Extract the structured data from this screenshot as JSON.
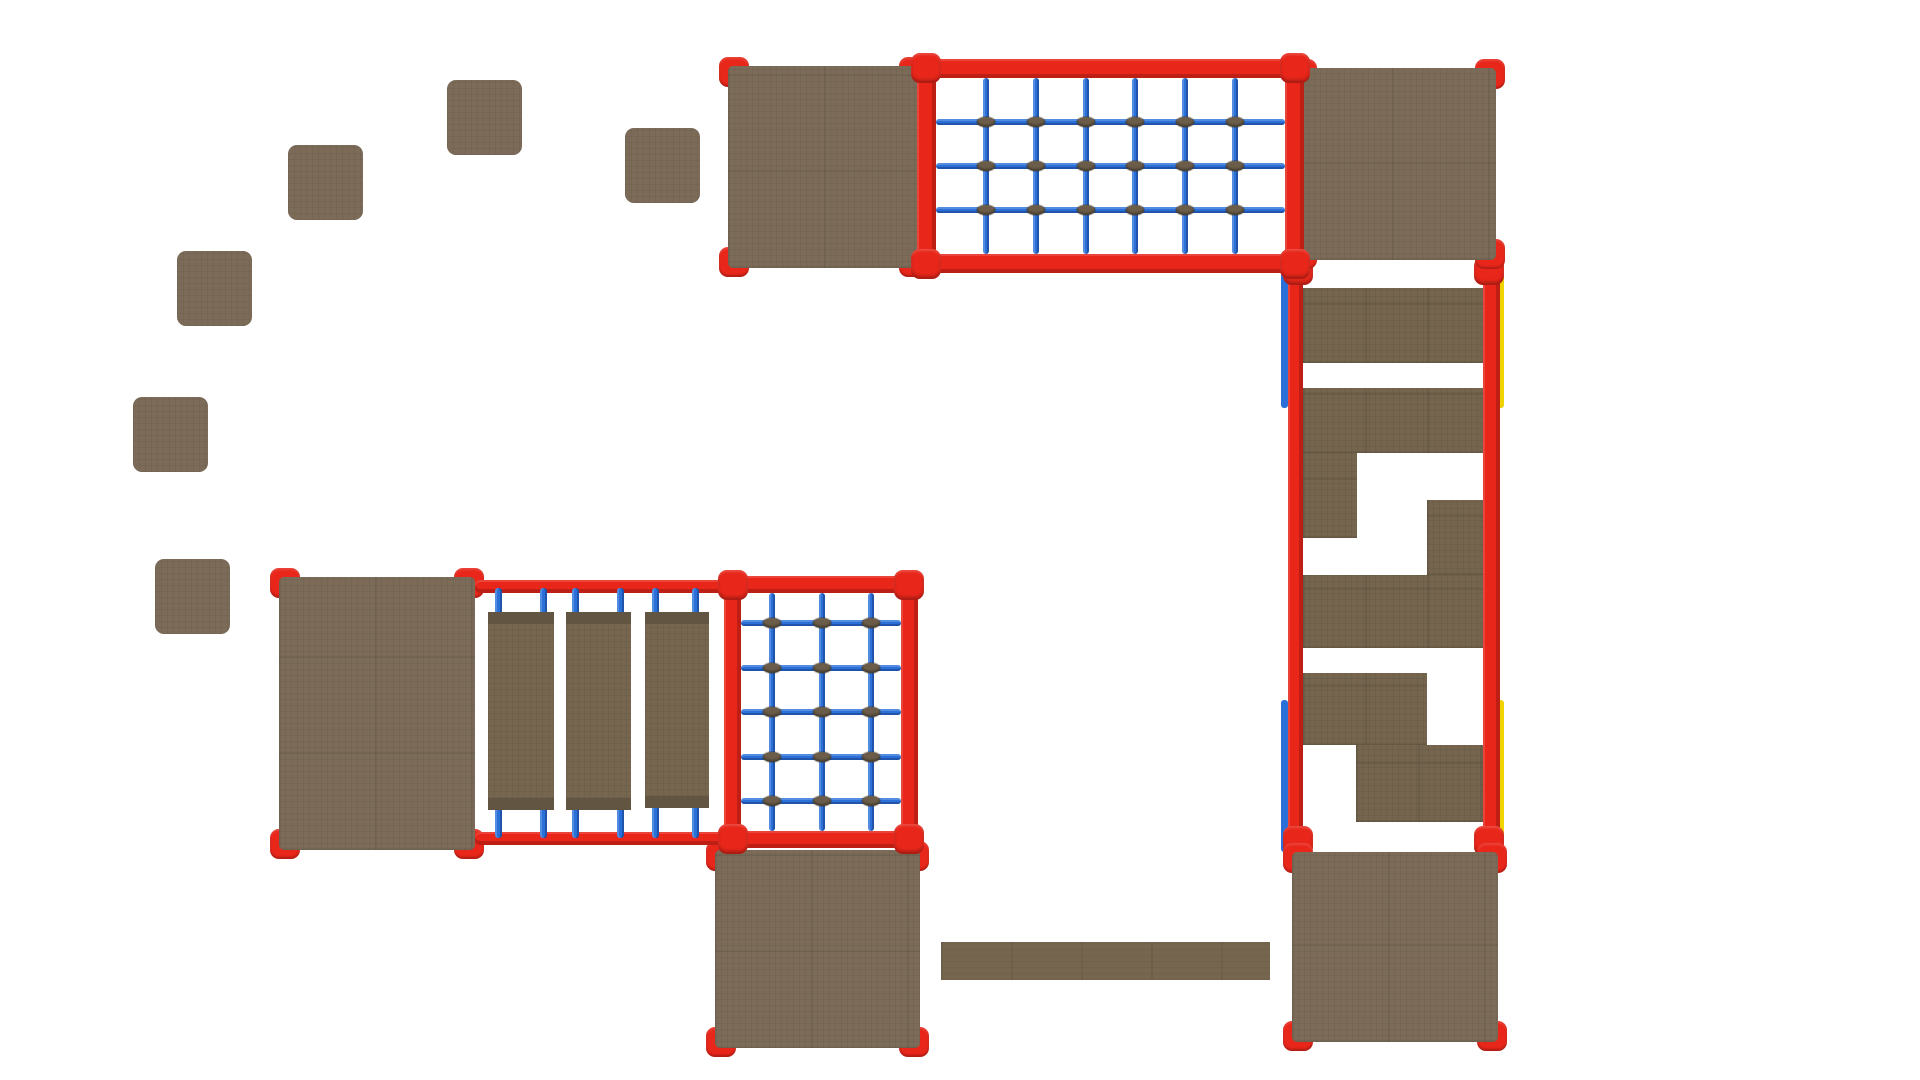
{
  "scene": {
    "canvas": {
      "width": 1920,
      "height": 1080,
      "background": "#ffffff"
    },
    "palette": {
      "wood": "#7b6b58",
      "wood_step": "#75654e",
      "wood_dark2": "#76664f",
      "wood_cap": "#5f5240",
      "red": "#e8261a",
      "blue": "#2a70d8",
      "yellow": "#efd402",
      "knot": "#6b5d49"
    },
    "stepping_stones": {
      "size": 75,
      "items": [
        {
          "x": 447,
          "y": 80
        },
        {
          "x": 288,
          "y": 145
        },
        {
          "x": 625,
          "y": 128
        },
        {
          "x": 177,
          "y": 251
        },
        {
          "x": 133,
          "y": 397
        },
        {
          "x": 155,
          "y": 559
        }
      ]
    },
    "platforms": [
      {
        "name": "deck-top-left",
        "x": 728,
        "y": 66,
        "w": 192,
        "h": 202
      },
      {
        "name": "deck-top-right",
        "x": 1296,
        "y": 68,
        "w": 200,
        "h": 192
      },
      {
        "name": "deck-left-large",
        "x": 279,
        "y": 577,
        "w": 196,
        "h": 273
      },
      {
        "name": "deck-bottom-middle",
        "x": 715,
        "y": 850,
        "w": 205,
        "h": 198
      },
      {
        "name": "deck-bottom-right",
        "x": 1292,
        "y": 852,
        "w": 206,
        "h": 190
      }
    ],
    "climbing_nets": [
      {
        "name": "climbing-net-top",
        "x": 917,
        "y": 59,
        "w": 387,
        "h": 214,
        "bar": 19,
        "vertical_ropes": [
          0.1429,
          0.2857,
          0.4286,
          0.5714,
          0.7143,
          0.8571
        ],
        "horizontal_ropes": [
          0.25,
          0.5,
          0.75
        ]
      },
      {
        "name": "climbing-net-lower",
        "x": 724,
        "y": 576,
        "w": 194,
        "h": 272,
        "bar": 17,
        "vertical_ropes": [
          0.195,
          0.505,
          0.815
        ],
        "horizontal_ropes": [
          0.126,
          0.314,
          0.499,
          0.688,
          0.872
        ]
      }
    ],
    "wobble_bridge": {
      "rails": [
        {
          "x": 475,
          "y": 580,
          "w": 252,
          "h": 13
        },
        {
          "x": 475,
          "y": 832,
          "w": 252,
          "h": 13
        }
      ],
      "rope_xs": [
        498,
        543,
        575,
        620,
        655,
        695
      ],
      "rope_w": 7,
      "rope_top": {
        "y": 588,
        "h": 32
      },
      "rope_bottom": {
        "y": 798,
        "h": 40
      },
      "planks": [
        {
          "x": 488,
          "y": 612,
          "w": 66,
          "h": 198
        },
        {
          "x": 566,
          "y": 612,
          "w": 65,
          "h": 198
        },
        {
          "x": 645,
          "y": 612,
          "w": 64,
          "h": 196
        }
      ],
      "cap_h": 12
    },
    "step_climber": {
      "rails": [
        {
          "x": 1288,
          "y": 261,
          "w": 15,
          "h": 591
        },
        {
          "x": 1483,
          "y": 261,
          "w": 17,
          "h": 591
        }
      ],
      "accents": [
        {
          "color": "blue",
          "x": 1281,
          "y": 258,
          "w": 7,
          "h": 150
        },
        {
          "color": "blue",
          "x": 1281,
          "y": 700,
          "w": 7,
          "h": 152
        },
        {
          "color": "yellow",
          "x": 1497,
          "y": 256,
          "w": 7,
          "h": 152
        },
        {
          "color": "yellow",
          "x": 1497,
          "y": 700,
          "w": 7,
          "h": 150
        }
      ],
      "steps": [
        {
          "x": 1303,
          "y": 288,
          "w": 180,
          "h": 75
        },
        {
          "x": 1303,
          "y": 388,
          "w": 180,
          "h": 65
        },
        {
          "x": 1303,
          "y": 453,
          "w": 54,
          "h": 85
        },
        {
          "x": 1427,
          "y": 500,
          "w": 56,
          "h": 75
        },
        {
          "x": 1303,
          "y": 575,
          "w": 180,
          "h": 73
        },
        {
          "x": 1303,
          "y": 673,
          "w": 124,
          "h": 72
        },
        {
          "x": 1356,
          "y": 745,
          "w": 127,
          "h": 77
        }
      ],
      "connectors": [
        {
          "x": 1283,
          "y": 257,
          "w": 30,
          "h": 28
        },
        {
          "x": 1474,
          "y": 257,
          "w": 30,
          "h": 28
        },
        {
          "x": 1283,
          "y": 826,
          "w": 30,
          "h": 30
        },
        {
          "x": 1474,
          "y": 826,
          "w": 30,
          "h": 30
        }
      ]
    },
    "balance_beam": {
      "x": 941,
      "y": 942,
      "w": 329,
      "h": 38
    }
  }
}
